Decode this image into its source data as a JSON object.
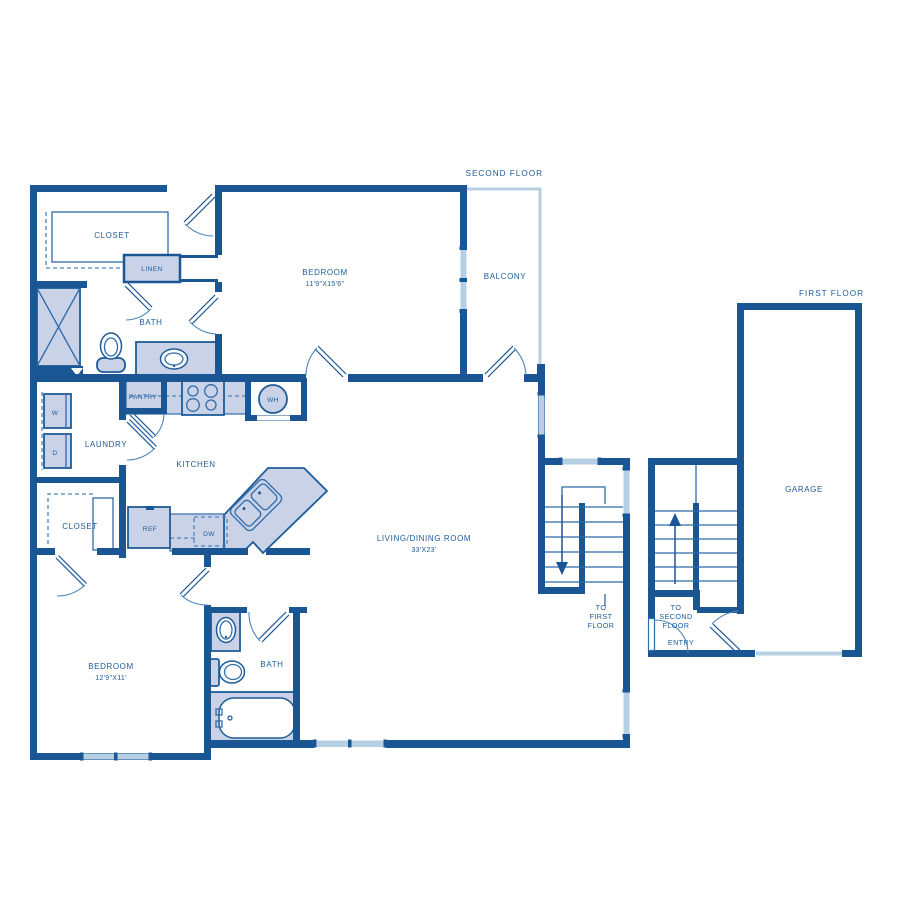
{
  "plan": {
    "second_floor": {
      "title": "SECOND FLOOR",
      "closet_master": "CLOSET",
      "linen": "LINEN",
      "bath_master": "BATH",
      "bedroom_master": "BEDROOM",
      "bedroom_master_dims": "11'9\"X15'6\"",
      "balcony": "BALCONY",
      "laundry": "LAUNDRY",
      "washer": "W",
      "dryer": "D",
      "pantry": "PANTRY",
      "water_heater": "WH",
      "kitchen": "KITCHEN",
      "refrigerator": "REF",
      "dishwasher": "DW",
      "closet_second": "CLOSET",
      "living": "LIVING/DINING ROOM",
      "living_dims": "33'X23'",
      "bedroom_second": "BEDROOM",
      "bedroom_second_dims": "12'9\"X11'",
      "bath_second": "BATH",
      "stairs_line1": "TO",
      "stairs_line2": "FIRST",
      "stairs_line3": "FLOOR"
    },
    "first_floor": {
      "title": "FIRST FLOOR",
      "garage": "GARAGE",
      "entry": "ENTRY",
      "stairs_line1": "TO",
      "stairs_line2": "SECOND",
      "stairs_line3": "FLOOR"
    },
    "colors": {
      "wall": "#1a5694",
      "fixture_fill": "#c9d2e6",
      "window": "#b7cfe2",
      "label": "#1d5c99"
    }
  }
}
